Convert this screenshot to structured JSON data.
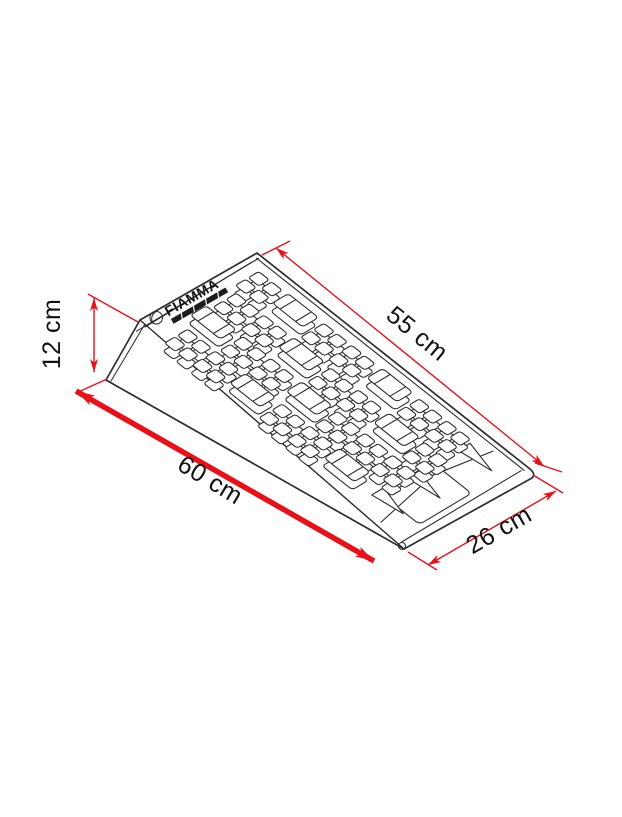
{
  "diagram": {
    "brand_logo": "FIAMMA",
    "dimensions": {
      "top_length": {
        "label": "55 cm"
      },
      "height": {
        "label": "12 cm"
      },
      "base_length": {
        "label": "60 cm"
      },
      "width": {
        "label": "26 cm"
      }
    },
    "colors": {
      "dimension_red": "#e8111a",
      "outline": "#2d2d2d",
      "label_text": "#111111",
      "background": "#ffffff"
    }
  }
}
